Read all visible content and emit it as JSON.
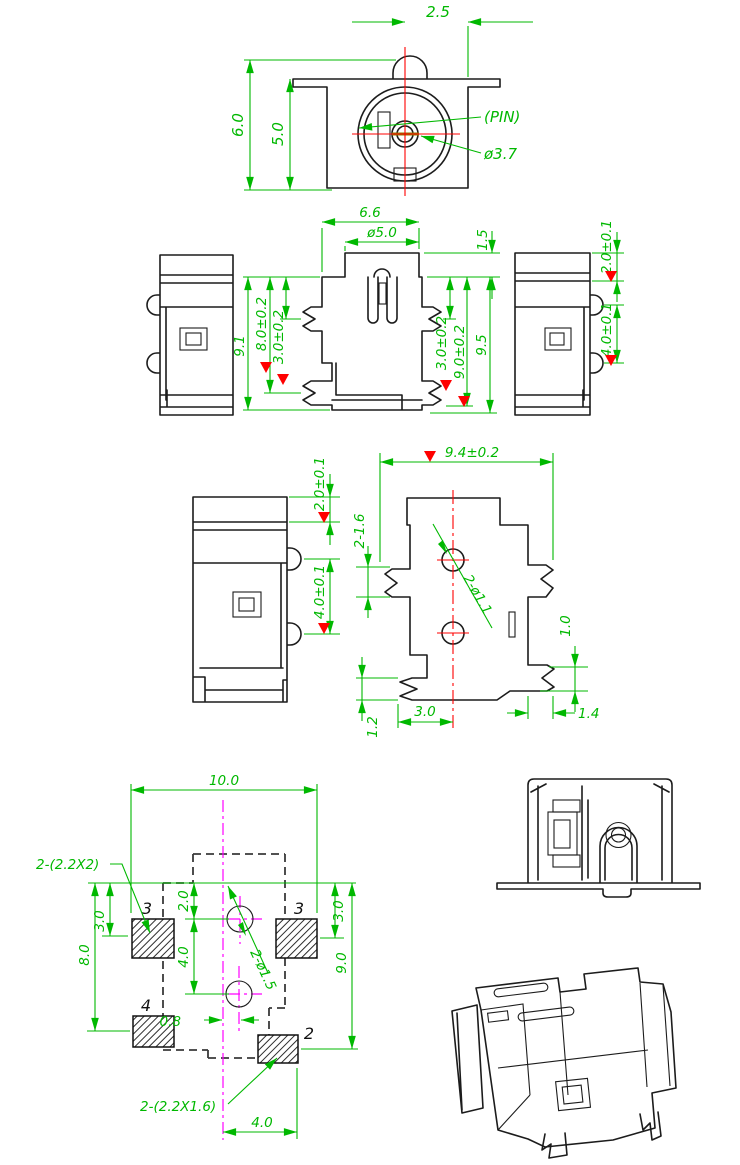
{
  "front_view": {
    "dim_width": "2.5",
    "dim_height_outer": "6.0",
    "dim_height_inner": "5.0",
    "label_pin": "(PIN)",
    "label_pin_dia": "ø3.7"
  },
  "front_elevation": {
    "dim_top_width": "6.6",
    "dim_bushing_dia": "ø5.0",
    "dim_bushing_h": "1.5",
    "dim_h_91": "9.1",
    "dim_h_80": "8.0±0.2",
    "dim_lug_30_left": "3.0±0.2",
    "dim_lug_30_right": "3.0±0.2",
    "dim_h_90": "9.0±0.2",
    "dim_h_95": "9.5"
  },
  "side_view_small": {
    "dim_cap": "2.0±0.1",
    "dim_pitch": "4.0±0.1"
  },
  "side_view_large": {
    "dim_cap": "2.0±0.1",
    "dim_pitch": "4.0±0.1"
  },
  "bottom_view": {
    "dim_width": "9.4±0.2",
    "dim_lugs": "2-1.6",
    "dim_holes": "2-ø1.1",
    "dim_lug_h": "1.0",
    "dim_foot_h": "1.2",
    "dim_hole_off": "3.0",
    "dim_foot_w": "1.4"
  },
  "pcb_layout": {
    "dim_width": "10.0",
    "label_pads_side": "2-(2.2X2)",
    "dim_pad3_off": "3.0",
    "dim_pad4_span": "8.0",
    "dim_hole_top": "2.0",
    "dim_hole_pitch": "4.0",
    "dim_hole_x": "0.8",
    "dim_pad3r_off": "3.0",
    "dim_pad2_span": "9.0",
    "label_holes": "2-ø1.5",
    "label_pads_bottom": "2-(2.2X1.6)",
    "dim_pad2_x": "4.0",
    "pads": [
      {
        "label": "3"
      },
      {
        "label": "3"
      },
      {
        "label": "4"
      },
      {
        "label": "2"
      }
    ]
  }
}
